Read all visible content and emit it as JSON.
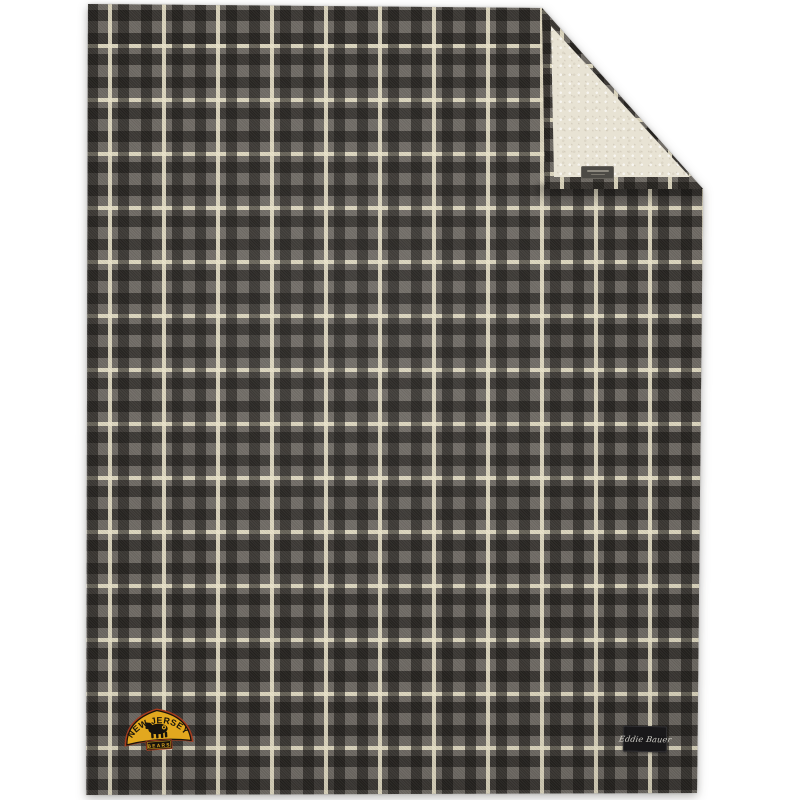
{
  "product": {
    "description": "Gray and cream plaid blanket with cream sherpa fleece backing, top-right corner folded over, product photo on white background",
    "background_color": "#ffffff"
  },
  "plaid": {
    "base_gray": "#6e6963",
    "dark_band": "#2a2724",
    "cream_stripe": "#ece5cb",
    "repeat_px": 54
  },
  "fleece": {
    "color": "#e8e3d4"
  },
  "patch": {
    "arch_text": "NEW JERSEY",
    "banner_text": "BEARS",
    "gold": "#e2a81f",
    "black": "#17130d",
    "border_rust": "#a83c1e"
  },
  "brand_tag": {
    "text": "Eddie Bauer",
    "bg": "#19181a",
    "text_color": "#d6d4cd"
  }
}
